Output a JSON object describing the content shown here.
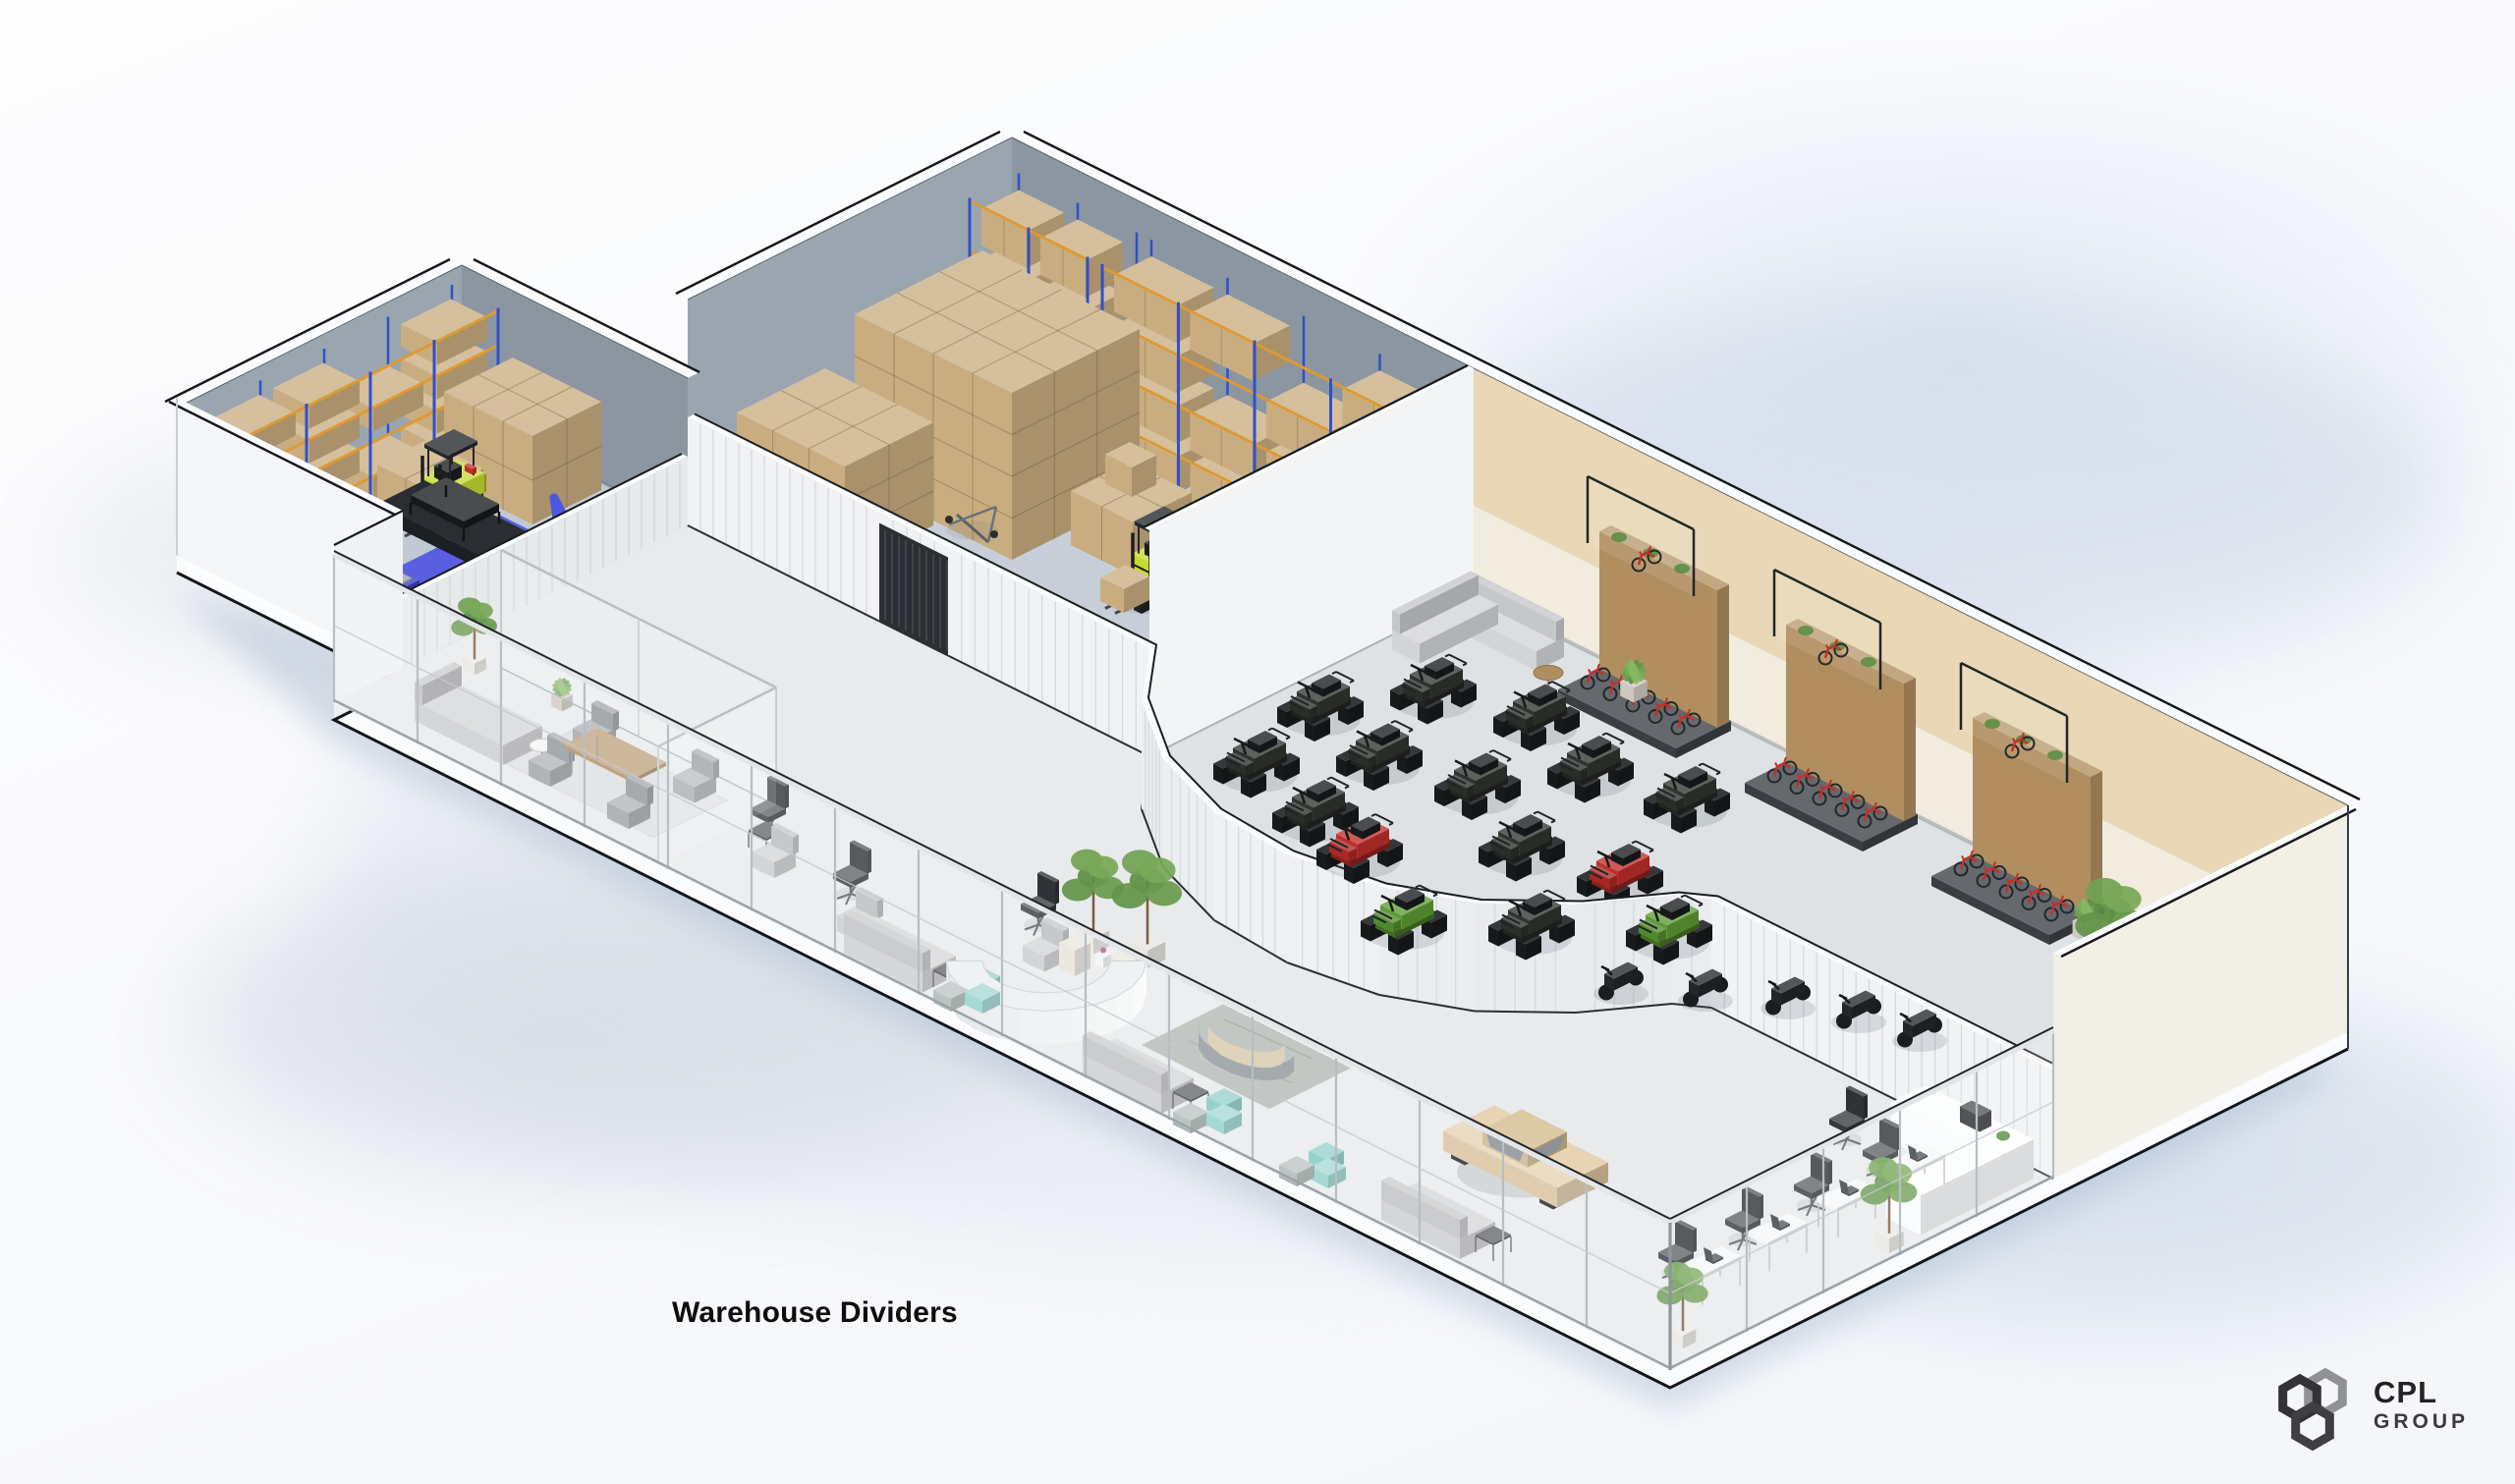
{
  "caption": {
    "text": "Warehouse Dividers"
  },
  "logo": {
    "company": "CPL",
    "division": "GROUP"
  },
  "scene": {
    "type": "isometric-warehouse-render",
    "zones": [
      "storage-room-with-robotic-assembly-cell",
      "pallet-racking-storage-room",
      "powersports-showroom",
      "office-lounge-gallery"
    ],
    "colors": {
      "edge_dark": "#17191c",
      "wall_gray_light": "#9aa5af",
      "wall_gray_dark": "#8b96a0",
      "wall_cream": "#e9d7b6",
      "wall_cream_low": "#f2ece0",
      "wall_white": "#f5f6f8",
      "divider_white": "#f1f2f4",
      "floor_storage": "#c7ced7",
      "floor_storage2": "#c1c9d2",
      "floor_showroom": "#dfe2e5",
      "floor_office": "#e8eaec",
      "slab_white": "#fbfcfd",
      "rack_blue": "#3050cc",
      "rack_beam": "#dd9a32",
      "box_tan": "#c9ad80",
      "forklift_yellow": "#c6da30",
      "robot_blue": "#4a5ae0",
      "machine_dark": "#1c1f23",
      "atv_dark": "#30342f",
      "atv_red": "#bf2e2a",
      "atv_green": "#5d9c33",
      "bike_red": "#c23128",
      "wood": "#b08e5f",
      "plant_green": "#5b8f45",
      "glass_frame": "#b7bec4",
      "shadow_blue": "#aebdd2"
    }
  }
}
